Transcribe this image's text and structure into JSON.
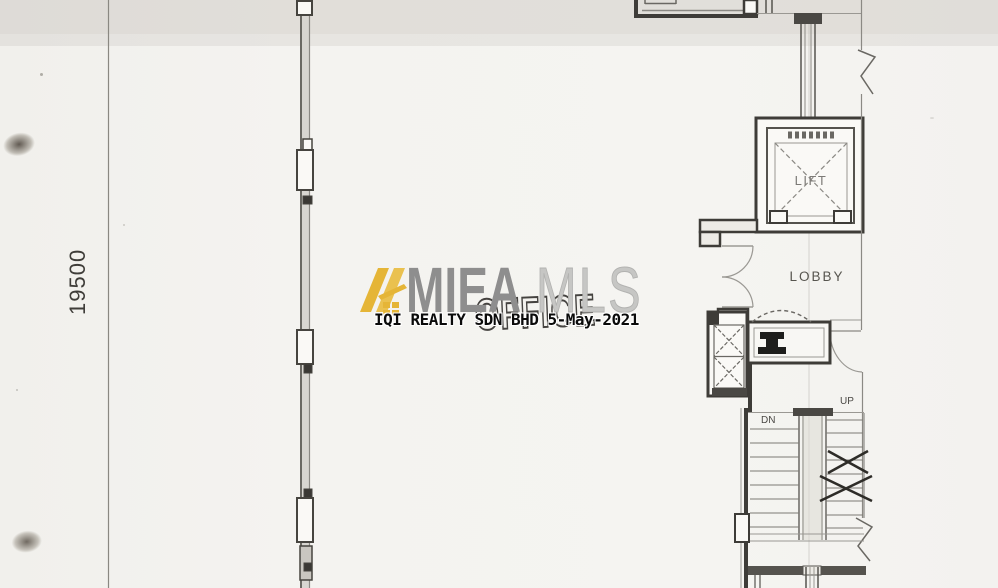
{
  "plan": {
    "dimension_label": "19500",
    "labels": {
      "office": "OFFICE",
      "lobby": "LOBBY",
      "lift": "LIFT",
      "stair_up": "UP",
      "stair_down": "DN"
    },
    "ink_color": "#4A4846",
    "paper_color": "#F4F3F0"
  },
  "watermark": {
    "brand_primary": "MIEA",
    "brand_secondary": "MLS",
    "stamp_text": "IQI REALTY SDN BHD 5-May-2021",
    "colors": {
      "logo_gold": "#E5B537",
      "brand_primary_gray": "#8E8E8E",
      "brand_secondary_gray": "#C6C6C4",
      "stamp_ink": "#0A0A0A"
    }
  }
}
